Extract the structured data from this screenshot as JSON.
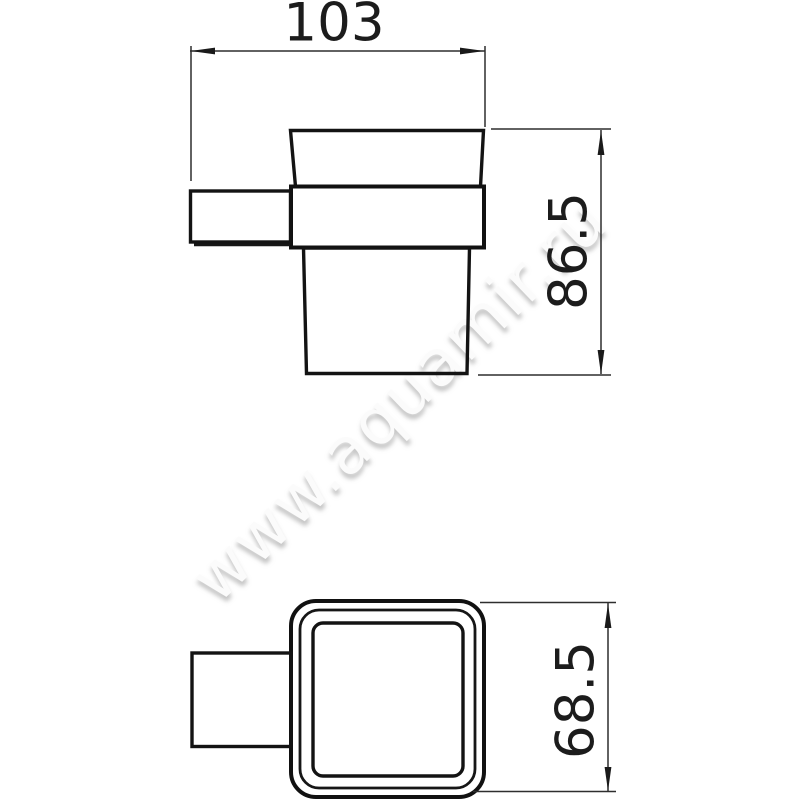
{
  "drawing": {
    "type": "technical-dimension-drawing",
    "subject": "wall-mounted square tumbler holder, front and bottom views",
    "dimensions": {
      "overall_depth_top": "103",
      "overall_height_side": "86.5",
      "cup_width_bottom": "68.5"
    },
    "watermark": {
      "text": "www.aquamir.ru"
    },
    "colors": {
      "background": "#ffffff",
      "object_line": "#131313",
      "dimension_line": "#2e2e2e",
      "label_text": "#1c1c1c",
      "watermark_shadow": "#969696"
    }
  }
}
